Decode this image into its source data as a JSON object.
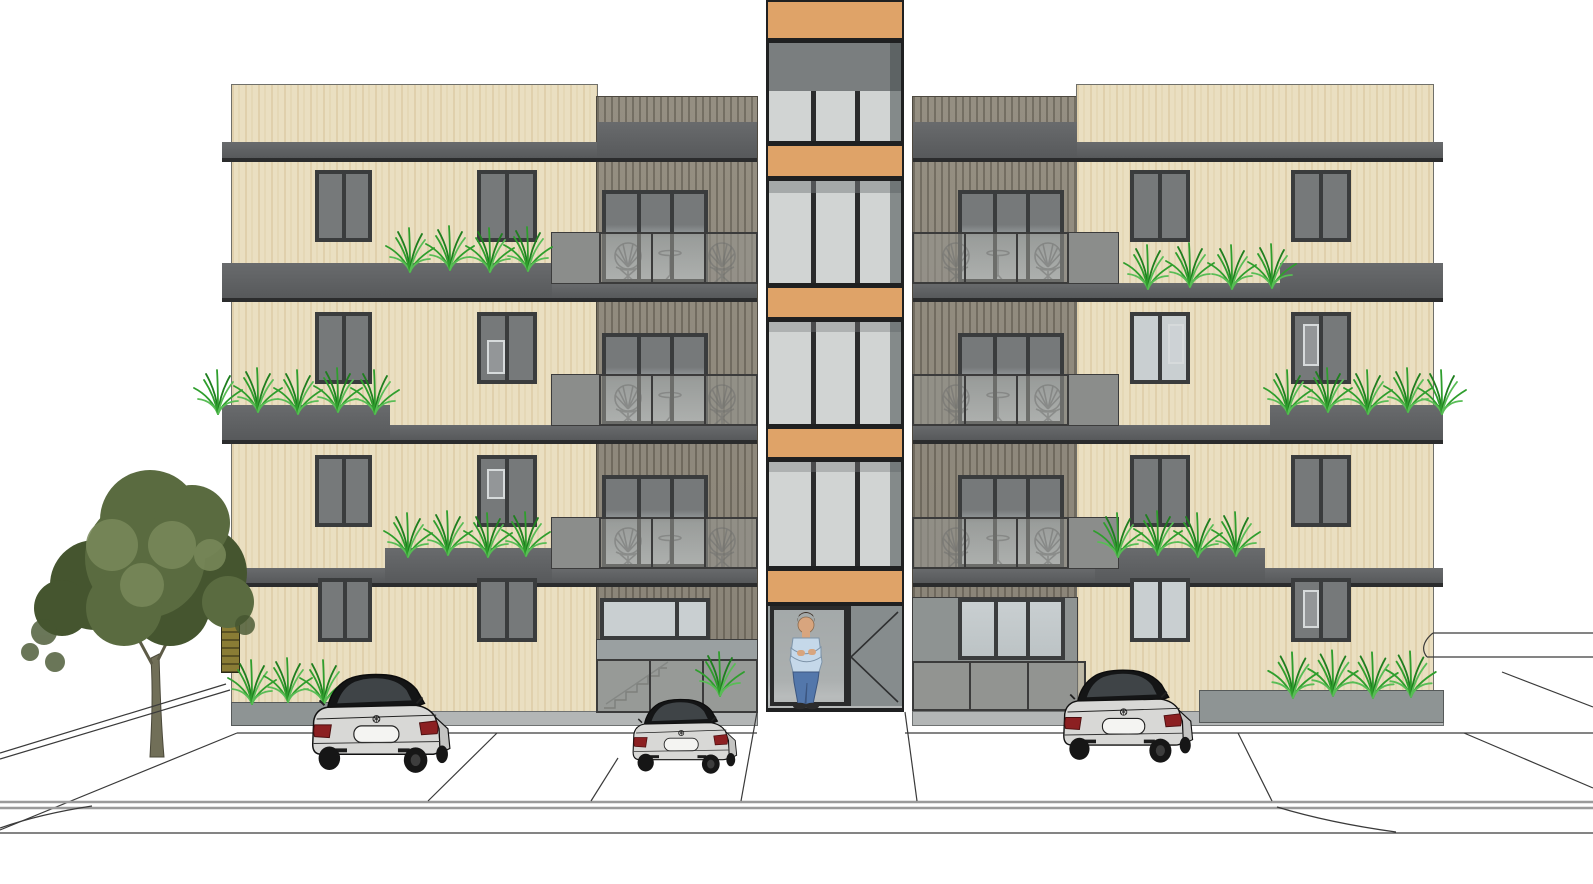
{
  "title": "Front elevation architectural rendering of a four-storey apartment building",
  "scene": {
    "style": "SketchUp-like colored elevation on white background",
    "building": {
      "label": "apartment building facade",
      "floors": 4,
      "cladding": "cream vertical wood siding with grey floor bands",
      "tower": {
        "label": "central stair-elevator tower",
        "orange_bands": 5,
        "glass_sections": 4,
        "panes_per_section": 3
      },
      "balconies": {
        "count": 6,
        "railing": "frosted glass",
        "furniture": "two round wicker chairs and a bistro table each"
      },
      "entrance": {
        "label": "glazed entrance door",
        "door_swing_symbol": true,
        "person": "man standing with crossed arms, light blue shirt, jeans"
      },
      "windows_note": "paired dark-framed windows on each wing and floor"
    },
    "site": {
      "cars": {
        "count": 3,
        "description": "silver sedans seen from rear, dark glass, red taillights"
      },
      "tree": {
        "count": 1,
        "position": "left of building"
      },
      "grass_planters": {
        "band_tufts": 26,
        "ground_tufts": 7
      },
      "ground": "parking stalls, sidewalk and street curb drawn as thin outlines"
    }
  },
  "colors": {
    "cream": "#eadfc1",
    "band": "#696b6d",
    "bandDark": "#57595b",
    "shadow": "#2b2c2d",
    "frame": "#3a3c3d",
    "glassDark": "#76797a",
    "glassMid": "#9fa6a8",
    "glassLight": "#c9cfd1",
    "orange": "#dfa368",
    "towerGlass": "#d1d4d3",
    "towerDark": "#7a7e7f",
    "railGlass": "rgba(150,150,144,0.55)",
    "railFrame": "#3b3b3b",
    "block": "#8b8d8b",
    "grass1": "#2f9e2d",
    "grass2": "#58bd55",
    "grass3": "#1f7f1f",
    "tree": "#5a6b40",
    "treeDark": "#45552f",
    "treeLight": "#79895a",
    "trunk": "#716f58",
    "carBody": "#d8d8d6",
    "carSide": "#c4c4c2",
    "carGlass": "#3f4447",
    "carDark": "#141516",
    "tail": "#8c2022",
    "line": "#3a3a3a",
    "curb": "#9b9b9b",
    "plinth": "#b3b6b6",
    "planter": "#8e9494",
    "interior": "#9aa0a1",
    "olive": "#8a7c35",
    "skin": "#d8a57e",
    "hair": "#3a2d24",
    "shirt": "#c5d8e9",
    "jeans": "#5377ab"
  }
}
